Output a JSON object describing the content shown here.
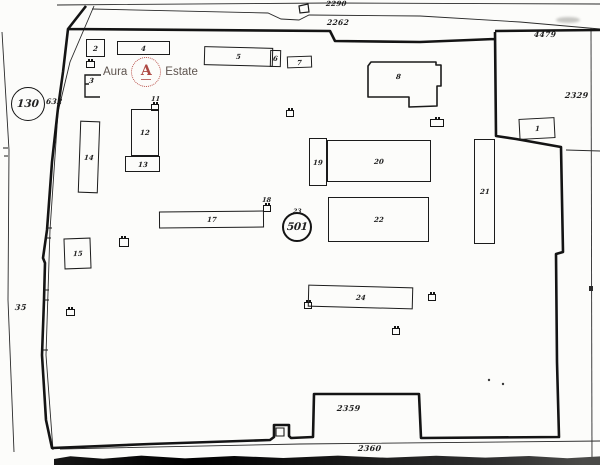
{
  "plan": {
    "background": "#fcfcfa",
    "ink": "#1b1b1b",
    "survey": {
      "circle_left": "130",
      "circle_center": "501",
      "circle_center_note": "23"
    },
    "labels": {
      "top_outer": "2290",
      "top_inner": "2262",
      "top_right": "4479",
      "right_parcel": "2329",
      "left_strip": "35",
      "left_road": "632",
      "bottom_parcel": "2359",
      "bottom_road": "2360"
    },
    "buildings": {
      "b1": "1",
      "b2": "2",
      "b3": "3",
      "b4": "4",
      "b5": "5",
      "b6": "6",
      "b7": "7",
      "b8": "8",
      "b12": "12",
      "b13": "13",
      "b14": "14",
      "b15": "15",
      "b17": "17",
      "b19": "19",
      "b20": "20",
      "b21": "21",
      "b22": "22",
      "b24": "24"
    },
    "markers": {
      "m11": "11",
      "m18": "18"
    }
  },
  "watermark": {
    "word_left": "Aura",
    "word_right": "Estate",
    "monogram": "A",
    "accent_color": "#a83a34",
    "text_color": "#50453f"
  }
}
